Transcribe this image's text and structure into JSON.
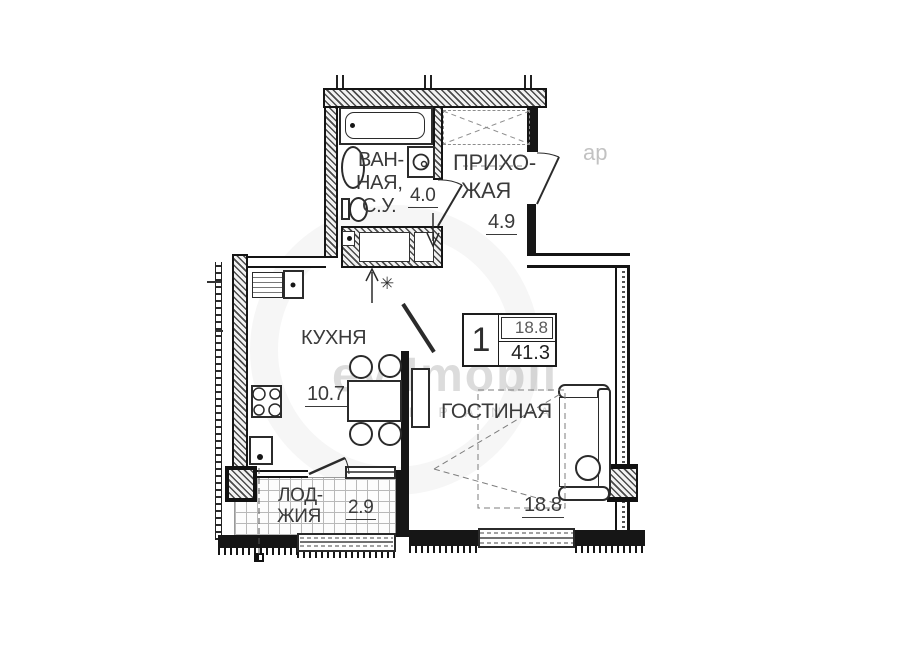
{
  "info_box": {
    "rooms": "1",
    "living_area": "18.8",
    "total_area": "41.3"
  },
  "rooms": {
    "bathroom": {
      "line1": "ВАН-",
      "line2": "НАЯ,",
      "line3": "С.У.",
      "area": "4.0"
    },
    "hallway": {
      "line1": "ПРИХО-",
      "line2": "ЖАЯ",
      "area": "4.9"
    },
    "kitchen": {
      "label": "КУХНЯ",
      "area": "10.7"
    },
    "living": {
      "label": "ГОСТИНАЯ",
      "area": "18.8"
    },
    "loggia": {
      "line1": "ЛОД-",
      "line2": "ЖИЯ",
      "area": "2.9"
    }
  },
  "watermark": {
    "main": "ey Imobil",
    "sub": "C O M P A N I A",
    "fragment": "ар"
  },
  "symbols": {
    "vent": "✳"
  },
  "colors": {
    "line": "#161616",
    "text": "#3a3a3a",
    "watermark": "#c8c8c8"
  }
}
